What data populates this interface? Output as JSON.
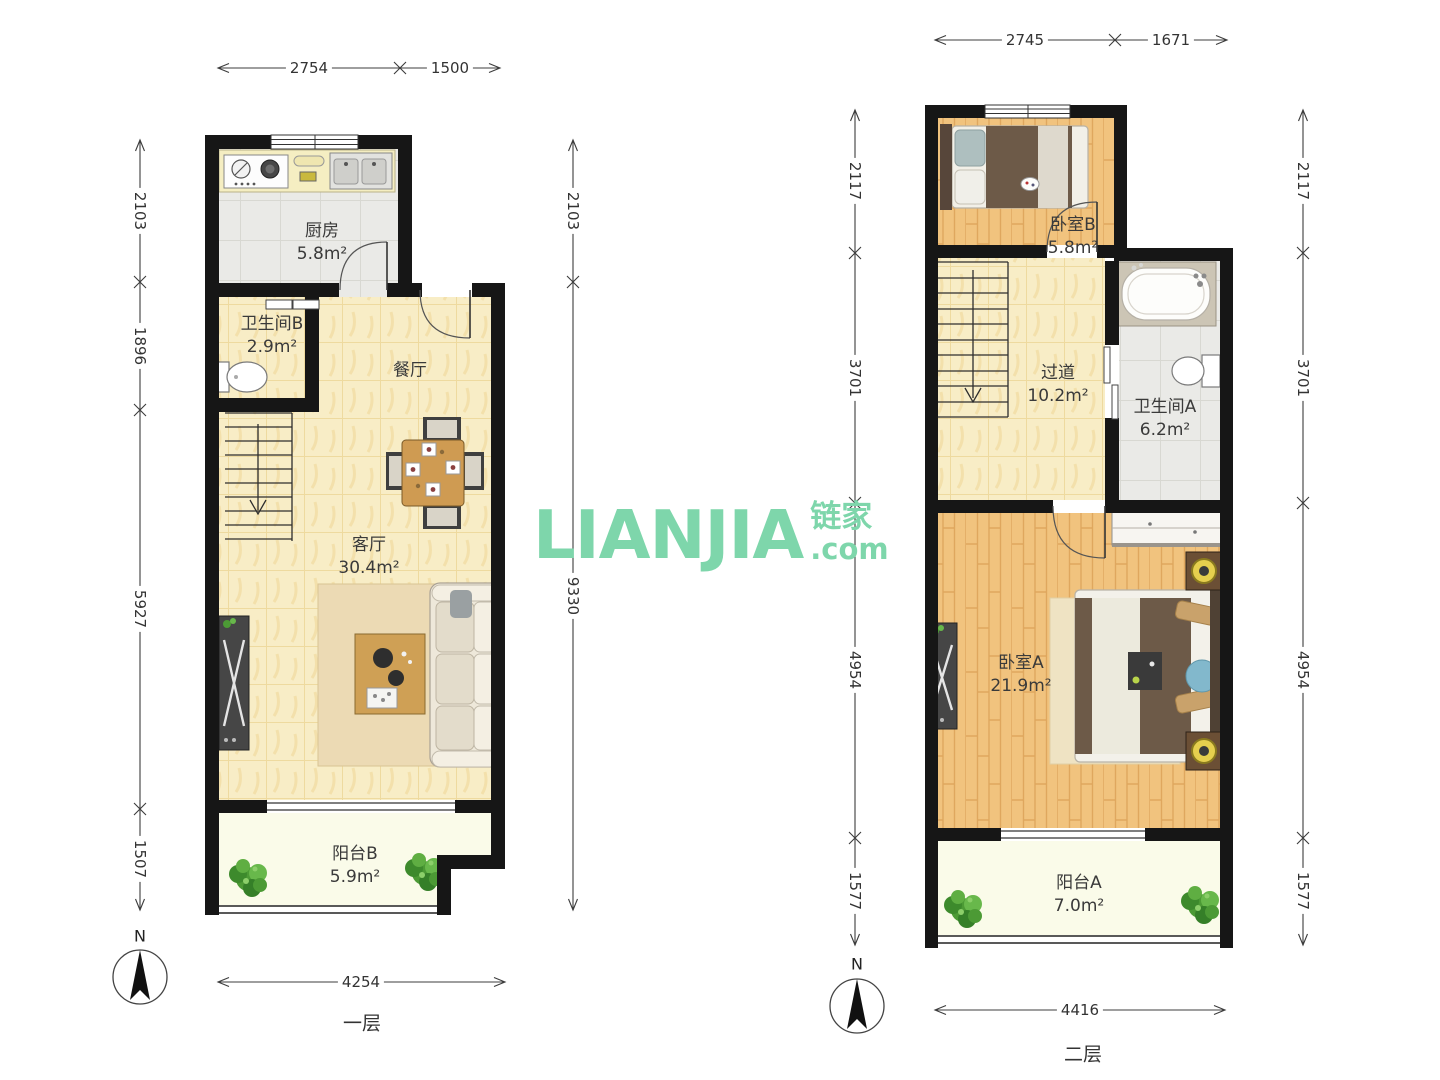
{
  "watermark": {
    "logo": "LIANJIA",
    "cjk": "链家",
    "dotcom": ".com",
    "color": "#7ed6ab"
  },
  "icons": {
    "north-arrow": "compass needle",
    "plant": "green plant",
    "stairs-arrow": "down arrow"
  },
  "floor1": {
    "name": "一层",
    "compass_label": "N",
    "rooms": {
      "kitchen": {
        "name": "厨房",
        "area": "5.8m²"
      },
      "bathroomB": {
        "name": "卫生间B",
        "area": "2.9m²"
      },
      "dining": {
        "name": "餐厅"
      },
      "living": {
        "name": "客厅",
        "area": "30.4m²"
      },
      "balconyB": {
        "name": "阳台B",
        "area": "5.9m²"
      }
    },
    "dims": {
      "top": [
        "2754",
        "1500"
      ],
      "left": [
        "2103",
        "1896",
        "5927",
        "1507"
      ],
      "right": [
        "2103",
        "9330"
      ],
      "bottom": [
        "4254"
      ]
    }
  },
  "floor2": {
    "name": "二层",
    "compass_label": "N",
    "rooms": {
      "bedroomB": {
        "name": "卧室B",
        "area": "5.8m²"
      },
      "hallway": {
        "name": "过道",
        "area": "10.2m²"
      },
      "bathroomA": {
        "name": "卫生间A",
        "area": "6.2m²"
      },
      "bedroomA": {
        "name": "卧室A",
        "area": "21.9m²"
      },
      "balconyA": {
        "name": "阳台A",
        "area": "7.0m²"
      }
    },
    "dims": {
      "top": [
        "2745",
        "1671"
      ],
      "left": [
        "2117",
        "3701",
        "4954",
        "1577"
      ],
      "right": [
        "2117",
        "3701",
        "4954",
        "1577"
      ],
      "bottom": [
        "4416"
      ]
    }
  }
}
